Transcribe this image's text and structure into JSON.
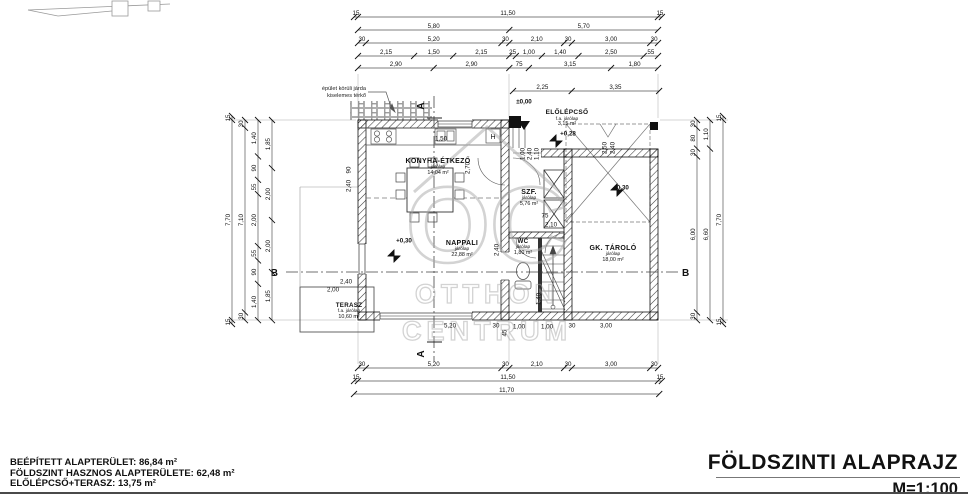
{
  "title_block": {
    "title": "FÖLDSZINTI ALAPRAJZ",
    "scale": "M=1:100"
  },
  "summary": {
    "line1": "BEÉPÍTETT ALAPTERÜLET: 86,84 m²",
    "line2": "FÖLDSZINT HASZNOS ALAPTERÜLETE: 62,48 m²",
    "line3": "ELŐLÉPCSŐ+TERASZ: 13,75 m²"
  },
  "note": {
    "line1": "épület körüli járda",
    "line2": "kiselemes térkő"
  },
  "watermark": {
    "logo": "OC",
    "line1": "OTTHON",
    "line2": "CENTRUM"
  },
  "rooms": {
    "konyha": {
      "name": "KONYHA-ÉTKEZŐ",
      "floor": "járólap",
      "area": "14,04 m²"
    },
    "nappali": {
      "name": "NAPPALI",
      "floor": "járólap",
      "area": "22,88 m²"
    },
    "terasz": {
      "name": "TERASZ",
      "floor": "f.a. járólap",
      "area": "10,60 m²"
    },
    "szf": {
      "name": "SZF.",
      "floor": "járólap",
      "area": "5,76 m²"
    },
    "wc": {
      "name": "WC",
      "floor": "járólap",
      "area": "1,80 m²"
    },
    "gk_tarolo": {
      "name": "GK. TÁROLÓ",
      "floor": "járólap",
      "area": "18,00 m²"
    },
    "elolepcso": {
      "name": "ELŐLÉPCSŐ",
      "floor": "f.a. járólap",
      "area": "3,15 m²"
    }
  },
  "levels": {
    "entry": "±0,00",
    "porch": "+0,28",
    "nappali": "+0,30",
    "garage": "+0,30"
  },
  "sections": {
    "a": "A",
    "b": "B"
  },
  "fixtures": {
    "boiler": "H"
  },
  "colors": {
    "line": "#111111",
    "watermark": "#a8a8a8",
    "rule": "#4a4a4a"
  },
  "dim_chains": [
    {
      "id": "top-1",
      "d": "h",
      "x": 354,
      "y": 17,
      "sc": 26.09,
      "seg": [
        [
          "15",
          0.15
        ],
        [
          "11,50",
          11.5
        ],
        [
          "15",
          0.15
        ]
      ]
    },
    {
      "id": "top-2",
      "d": "h",
      "x": 358,
      "y": 30,
      "sc": 26.09,
      "seg": [
        [
          "5,80",
          5.8
        ],
        [
          "5,70",
          5.7
        ]
      ]
    },
    {
      "id": "top-3",
      "d": "h",
      "x": 358,
      "y": 43,
      "sc": 26.09,
      "seg": [
        [
          "30",
          0.3
        ],
        [
          "5,20",
          5.2
        ],
        [
          "30",
          0.3
        ],
        [
          "2,10",
          2.1
        ],
        [
          "30",
          0.3
        ],
        [
          "3,00",
          3.0
        ],
        [
          "30",
          0.3
        ]
      ]
    },
    {
      "id": "top-4",
      "d": "h",
      "x": 358,
      "y": 56,
      "sc": 26.09,
      "seg": [
        [
          "2,15",
          2.15
        ],
        [
          "1,50",
          1.5
        ],
        [
          "2,15",
          2.15
        ],
        [
          "25",
          0.25
        ],
        [
          "1,00",
          1.0
        ],
        [
          "1,40",
          1.4
        ],
        [
          "2,50",
          2.5
        ],
        [
          "55",
          0.55
        ]
      ]
    },
    {
      "id": "top-5",
      "d": "h",
      "x": 358,
      "y": 68,
      "sc": 26.09,
      "seg": [
        [
          "2,90",
          2.9
        ],
        [
          "2,90",
          2.9
        ],
        [
          "75",
          0.75
        ],
        [
          "3,15",
          3.15
        ],
        [
          "1,80",
          1.8
        ]
      ]
    },
    {
      "id": "porch",
      "d": "h",
      "x": 513,
      "y": 91,
      "sc": 26.09,
      "seg": [
        [
          "2,25",
          2.25
        ],
        [
          "3,35",
          3.35
        ]
      ]
    },
    {
      "id": "bottom-1",
      "d": "h",
      "x": 358,
      "y": 368,
      "sc": 26.09,
      "seg": [
        [
          "30",
          0.3
        ],
        [
          "5,20",
          5.2
        ],
        [
          "30",
          0.3
        ],
        [
          "2,10",
          2.1
        ],
        [
          "30",
          0.3
        ],
        [
          "3,00",
          3.0
        ],
        [
          "30",
          0.3
        ]
      ]
    },
    {
      "id": "bottom-2",
      "d": "h",
      "x": 354,
      "y": 381,
      "sc": 26.09,
      "seg": [
        [
          "15",
          0.15
        ],
        [
          "11,50",
          11.5
        ],
        [
          "15",
          0.15
        ]
      ]
    },
    {
      "id": "bottom-3",
      "d": "h",
      "x": 354,
      "y": 394,
      "sc": 26.09,
      "seg": [
        [
          "11,70",
          11.7
        ]
      ]
    },
    {
      "id": "left-1",
      "d": "v",
      "x": 232,
      "y": 116,
      "sc": 26,
      "seg": [
        [
          "15",
          0.15
        ],
        [
          "7,70",
          7.7
        ],
        [
          "15",
          0.15
        ]
      ]
    },
    {
      "id": "left-2",
      "d": "v",
      "x": 245,
      "y": 120,
      "sc": 26,
      "seg": [
        [
          "30",
          0.3
        ],
        [
          "7,10",
          7.1
        ],
        [
          "30",
          0.3
        ]
      ]
    },
    {
      "id": "left-3",
      "d": "v",
      "x": 258,
      "y": 120,
      "sc": 26,
      "seg": [
        [
          "1,40",
          1.4
        ],
        [
          "90",
          0.9
        ],
        [
          "55",
          0.55
        ],
        [
          "2,00",
          2.0
        ],
        [
          "55",
          0.55
        ],
        [
          "90",
          0.9
        ],
        [
          "1,40",
          1.4
        ]
      ]
    },
    {
      "id": "left-4",
      "d": "v",
      "x": 272,
      "y": 120,
      "sc": 26,
      "seg": [
        [
          "1,85",
          1.85
        ],
        [
          "2,00",
          2.0
        ],
        [
          "2,00",
          2.0
        ],
        [
          "1,85",
          1.85
        ]
      ]
    },
    {
      "id": "right-1",
      "d": "v",
      "x": 697,
      "y": 120,
      "sc": 26,
      "seg": [
        [
          "30",
          0.3
        ],
        [
          "80",
          0.8
        ],
        [
          "30",
          0.3
        ],
        [
          "6,00",
          6.0
        ],
        [
          "30",
          0.3
        ]
      ]
    },
    {
      "id": "right-2",
      "d": "v",
      "x": 710,
      "y": 120,
      "sc": 26,
      "seg": [
        [
          "1,10",
          1.1
        ],
        [
          "6,60",
          6.6
        ]
      ]
    },
    {
      "id": "right-3",
      "d": "v",
      "x": 723,
      "y": 116,
      "sc": 26,
      "seg": [
        [
          "15",
          0.15
        ],
        [
          "7,70",
          7.7
        ],
        [
          "15",
          0.15
        ]
      ]
    }
  ],
  "inline_dims": [
    {
      "t": "1,50",
      "x": 441,
      "y": 139
    },
    {
      "t": "2,70",
      "x": 468,
      "y": 168,
      "r": 1
    },
    {
      "t": "2,40",
      "x": 497,
      "y": 250,
      "r": 1
    },
    {
      "t": "90",
      "x": 349,
      "y": 170,
      "r": 1
    },
    {
      "t": "2,40",
      "x": 349,
      "y": 186,
      "r": 1
    },
    {
      "t": "2,40",
      "x": 346,
      "y": 282
    },
    {
      "t": "2,00",
      "x": 333,
      "y": 290
    },
    {
      "t": "75",
      "x": 545,
      "y": 216
    },
    {
      "t": "2,10",
      "x": 551,
      "y": 225
    },
    {
      "t": "1,00",
      "x": 519,
      "y": 327
    },
    {
      "t": "1,00",
      "x": 547,
      "y": 327
    },
    {
      "t": "5,20",
      "x": 450,
      "y": 326
    },
    {
      "t": "30",
      "x": 496,
      "y": 326
    },
    {
      "t": "30",
      "x": 572,
      "y": 326
    },
    {
      "t": "3,00",
      "x": 606,
      "y": 326
    },
    {
      "t": "45",
      "x": 505,
      "y": 333,
      "r": 1
    },
    {
      "t": "1,40",
      "x": 539,
      "y": 299,
      "r": 1
    },
    {
      "t": "1,00",
      "x": 523,
      "y": 154,
      "r": 1
    },
    {
      "t": "2,40",
      "x": 530,
      "y": 154,
      "r": 1
    },
    {
      "t": "1,10",
      "x": 537,
      "y": 154,
      "r": 1
    },
    {
      "t": "2,50",
      "x": 605,
      "y": 148,
      "r": 1
    },
    {
      "t": "2,40",
      "x": 613,
      "y": 148,
      "r": 1
    }
  ]
}
